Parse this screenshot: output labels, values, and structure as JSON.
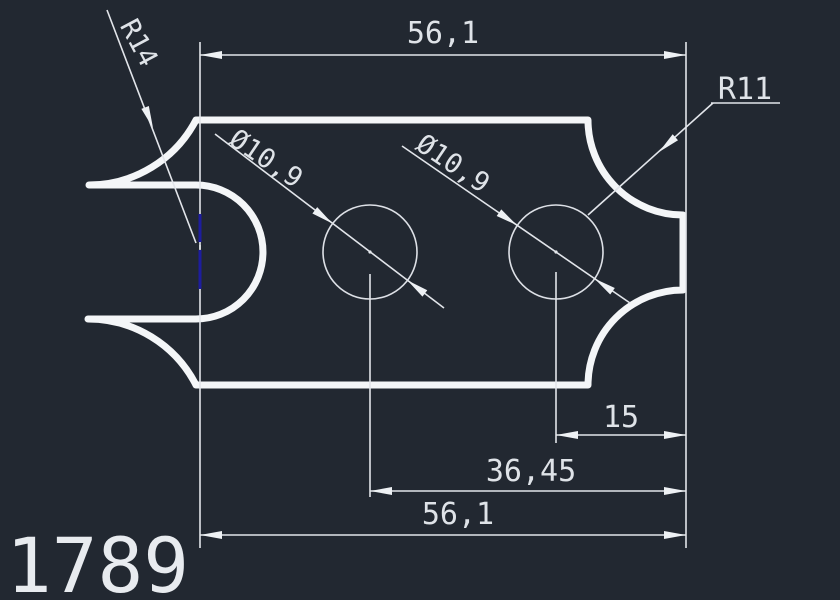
{
  "drawing": {
    "part_number": "1789",
    "dims": {
      "top_width": "56,1",
      "bottom_width": "56,1",
      "hole1_diameter": "Ø10,9",
      "hole2_diameter": "Ø10,9",
      "hole1_offset": "36,45",
      "hole2_offset": "15",
      "left_radius": "R14",
      "corner_radius": "R11"
    },
    "colors": {
      "background": "#222831",
      "line": "#f4f6f8",
      "dim_line": "#e2e5ea",
      "highlight_blue": "#1d1d9e"
    }
  }
}
